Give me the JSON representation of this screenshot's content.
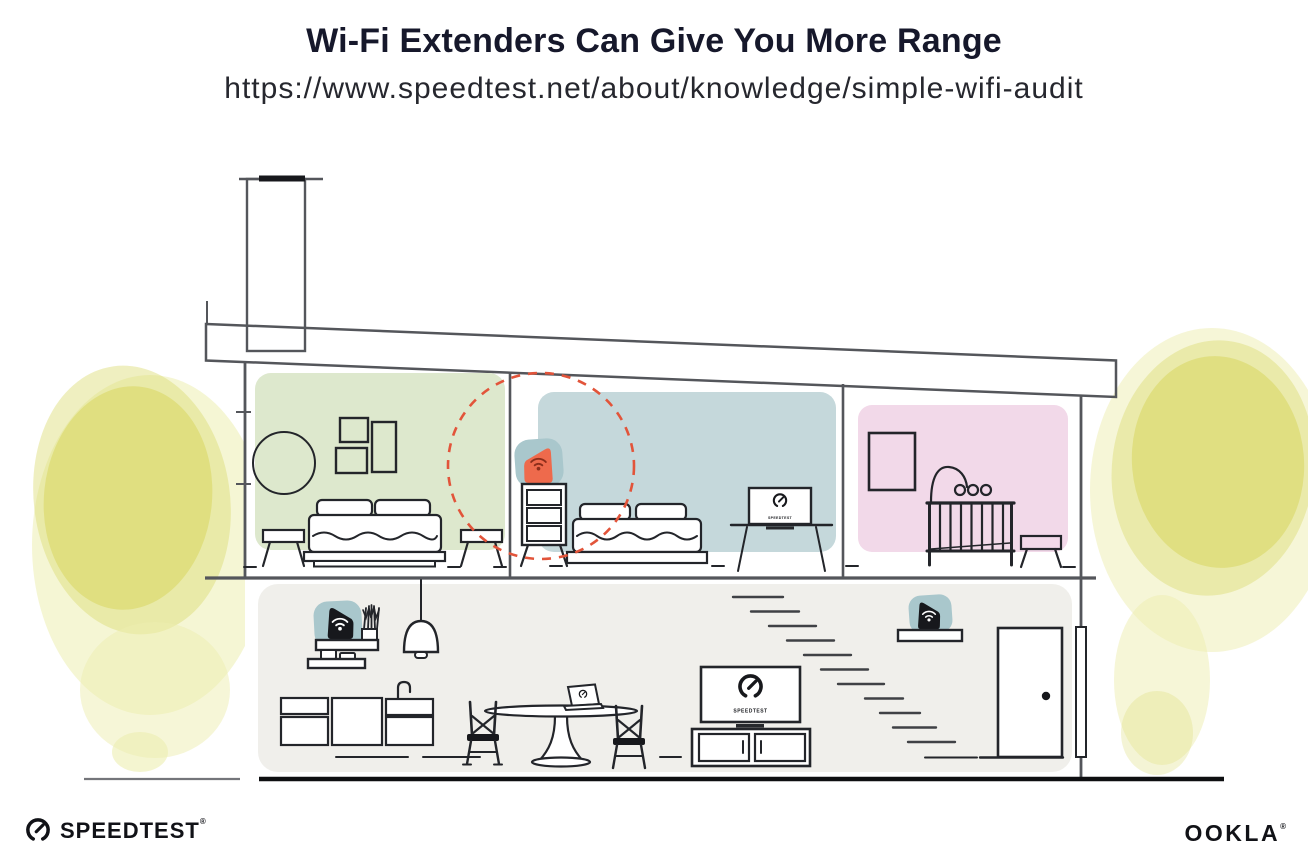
{
  "header": {
    "title": "Wi-Fi Extenders Can Give You More Range",
    "url": "https://www.speedtest.net/about/knowledge/simple-wifi-audit"
  },
  "footer": {
    "speedtest": {
      "label": "SPEEDTEST",
      "registered": "®"
    },
    "ookla": {
      "label": "OOKLA",
      "registered": "®"
    }
  },
  "illustration": {
    "tv_label": "SPEEDTEST",
    "icons": {
      "gauge": "speedtest-gauge-icon",
      "wifi": "wifi-icon",
      "extender": "wifi-extender-icon",
      "router": "router-icon"
    }
  },
  "colors": {
    "page_bg": "#ffffff",
    "title_text": "#16182b",
    "url_text": "#26272e",
    "line_dark": "#23252a",
    "line_structure": "#54565b",
    "room_green": "#dde8cd",
    "room_blue": "#c5d8db",
    "room_pink": "#f2d9e9",
    "floor_gray": "#f0efeb",
    "router_blob_teal": "#a9c7cc",
    "extender_orange": "#ee6a4c",
    "extender_wifi_dark": "#8c2e1b",
    "range_circle_red": "#e2543a",
    "tree_yellow": "#dcdb73",
    "tree_yellow_light": "#edeeb0",
    "logo_black": "#111217"
  }
}
